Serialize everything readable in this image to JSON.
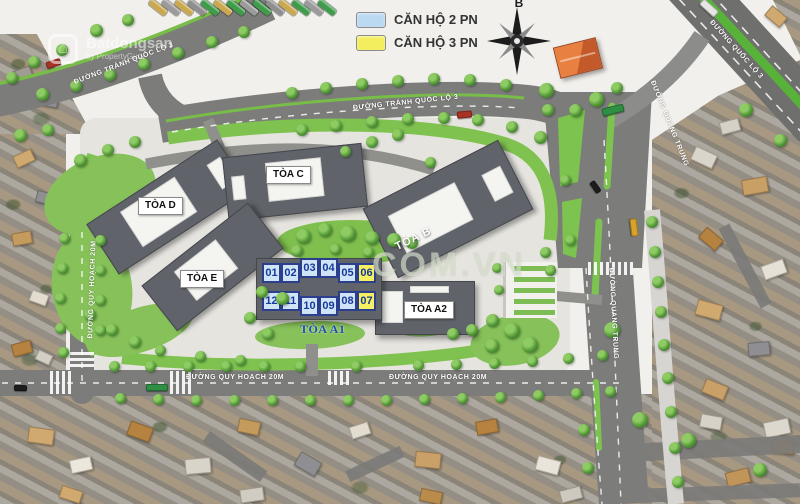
{
  "legend": {
    "items": [
      {
        "label": "CĂN HỘ 2 PN",
        "color": "#bcd9f2"
      },
      {
        "label": "CĂN HỘ 3 PN",
        "color": "#f3ee5e"
      }
    ]
  },
  "compass": {
    "north_label": "B"
  },
  "roads": {
    "tranh_quoc_lo_3_left": "ĐƯỜNG TRÁNH QUỐC LỘ 3",
    "tranh_quoc_lo_3_mid": "ĐƯỜNG TRÁNH QUỐC LỘ 3",
    "quoc_lo_3": "ĐƯỜNG QUỐC LỘ 3",
    "quang_trung_top": "ĐƯỜNG QUANG TRUNG",
    "quang_trung_bottom": "ĐƯỜNG QUANG TRUNG",
    "quy_hoach_left": "ĐƯỜNG QUY HOẠCH 20M",
    "quy_hoach_bottom_1": "ĐƯỜNG QUY HOẠCH 20M",
    "quy_hoach_bottom_2": "ĐƯỜNG QUY HOẠCH 20M"
  },
  "buildings": {
    "a1": "TÒA A1",
    "a2": "TÒA A2",
    "b": "TÒA B",
    "c": "TÒA C",
    "d": "TÒA D",
    "e": "TÒA E"
  },
  "units": {
    "top": [
      {
        "no": "01",
        "type": "2PN"
      },
      {
        "no": "02",
        "type": "2PN"
      },
      {
        "no": "03",
        "type": "2PN"
      },
      {
        "no": "04",
        "type": "2PN"
      },
      {
        "no": "05",
        "type": "2PN"
      },
      {
        "no": "06",
        "type": "3PN"
      }
    ],
    "bottom": [
      {
        "no": "12",
        "type": "2PN"
      },
      {
        "no": "11",
        "type": "2PN"
      },
      {
        "no": "10",
        "type": "2PN"
      },
      {
        "no": "09",
        "type": "2PN"
      },
      {
        "no": "08",
        "type": "2PN"
      },
      {
        "no": "07",
        "type": "3PN"
      }
    ]
  },
  "watermarks": {
    "brand": "Batdongsan",
    "brand_sub": "by PropertyGuru",
    "center": "COM.VN"
  }
}
